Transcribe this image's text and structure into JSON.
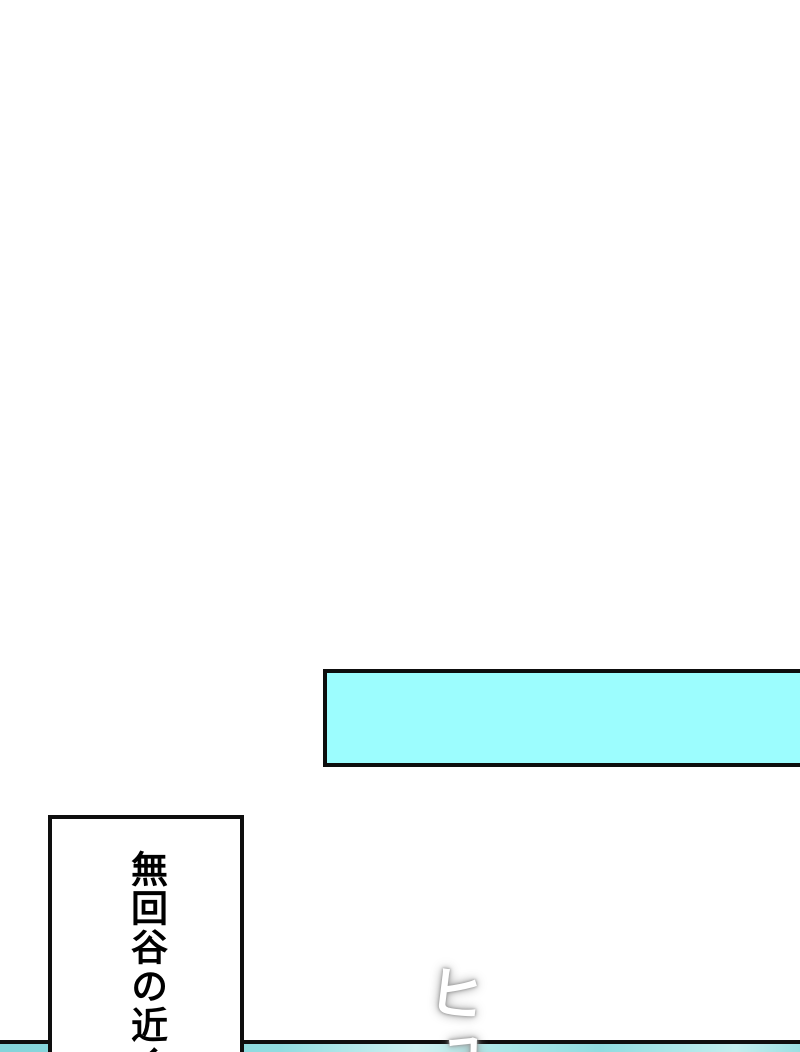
{
  "page": {
    "background": "#ffffff"
  },
  "panels": {
    "top": {
      "fill": "#9cfdfe",
      "border": "#0e0e0e"
    },
    "bottom_strip": {
      "border": "#0e0e0e",
      "colors": [
        "#84d4da",
        "#90dce0",
        "#cff1f1",
        "#abe7e8",
        "#8fdce0",
        "#c2eeee",
        "#9adfe2"
      ]
    }
  },
  "speech_box": {
    "text": "無回谷の近く",
    "fill": "#ffffff",
    "border": "#0e0e0e",
    "text_color": "#000000"
  },
  "sfx": {
    "text": "ヒュ",
    "chars": [
      "ヒ",
      "ュ"
    ],
    "color": "#ffffff",
    "glow": "#9a9a9a"
  }
}
